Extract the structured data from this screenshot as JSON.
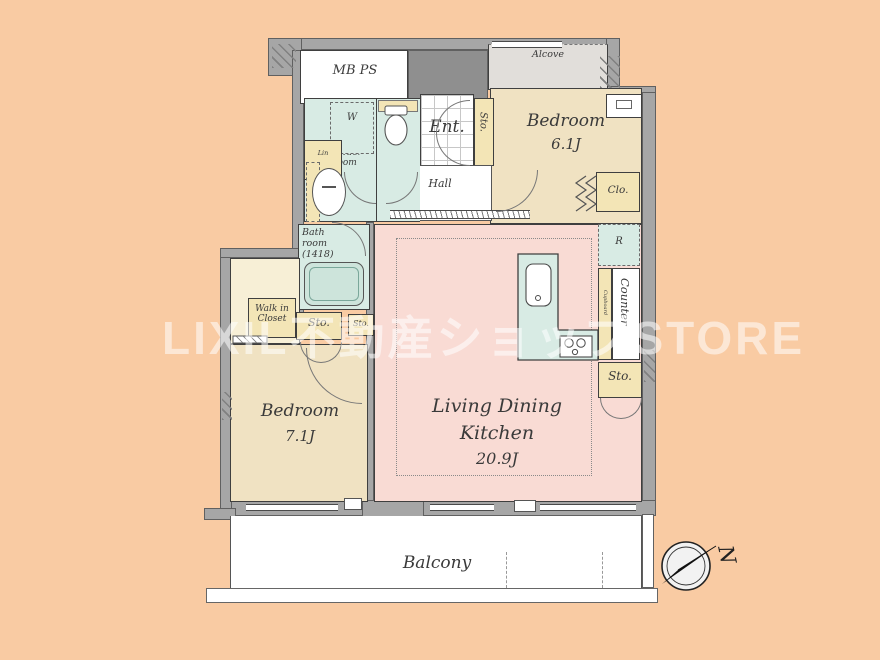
{
  "watermark": "LIXIL不動産ショップSTORE",
  "rooms": {
    "mb_ps": "MB PS",
    "alcove": "Alcove",
    "bedroom1": {
      "name": "Bedroom",
      "size": "6.1J"
    },
    "bedroom2": {
      "name": "Bedroom",
      "size": "7.1J"
    },
    "ldk": {
      "line1": "Living Dining",
      "line2": "Kitchen",
      "size": "20.9J"
    },
    "entrance": "Ent.",
    "hall": "Hall",
    "powder_room": {
      "line1": "Powder",
      "line2": "room"
    },
    "bath": {
      "line1": "Bath",
      "line2": "room",
      "line3": "(1418)"
    },
    "walk_in_closet": {
      "line1": "Walk in",
      "line2": "Closet"
    },
    "balcony": "Balcony"
  },
  "fixtures": {
    "washer": "W",
    "linen": "Lin",
    "storage": "Sto.",
    "closet": "Clo.",
    "refrigerator": "R",
    "counter": "Counter",
    "cupboard": "Cupboard",
    "shelf": "Shelf"
  },
  "compass": {
    "north_label": "N"
  }
}
